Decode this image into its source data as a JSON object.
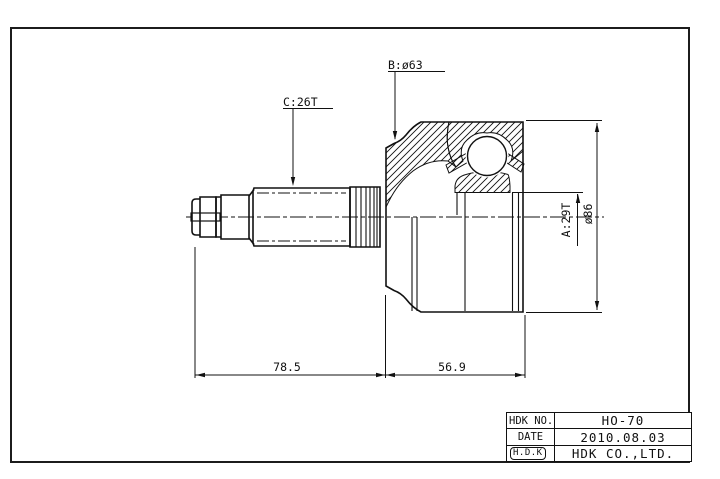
{
  "labels": {
    "b": "B:ø63",
    "c": "C:26T",
    "a": "A:29T",
    "dia": "ø86",
    "len_left": "78.5",
    "len_right": "56.9"
  },
  "title_block": {
    "rows": [
      {
        "label": "HDK NO.",
        "value": "HO-70"
      },
      {
        "label": "DATE",
        "value": "2010.08.03"
      },
      {
        "label": "H.D.K",
        "value": "HDK CO.,LTD."
      }
    ]
  }
}
